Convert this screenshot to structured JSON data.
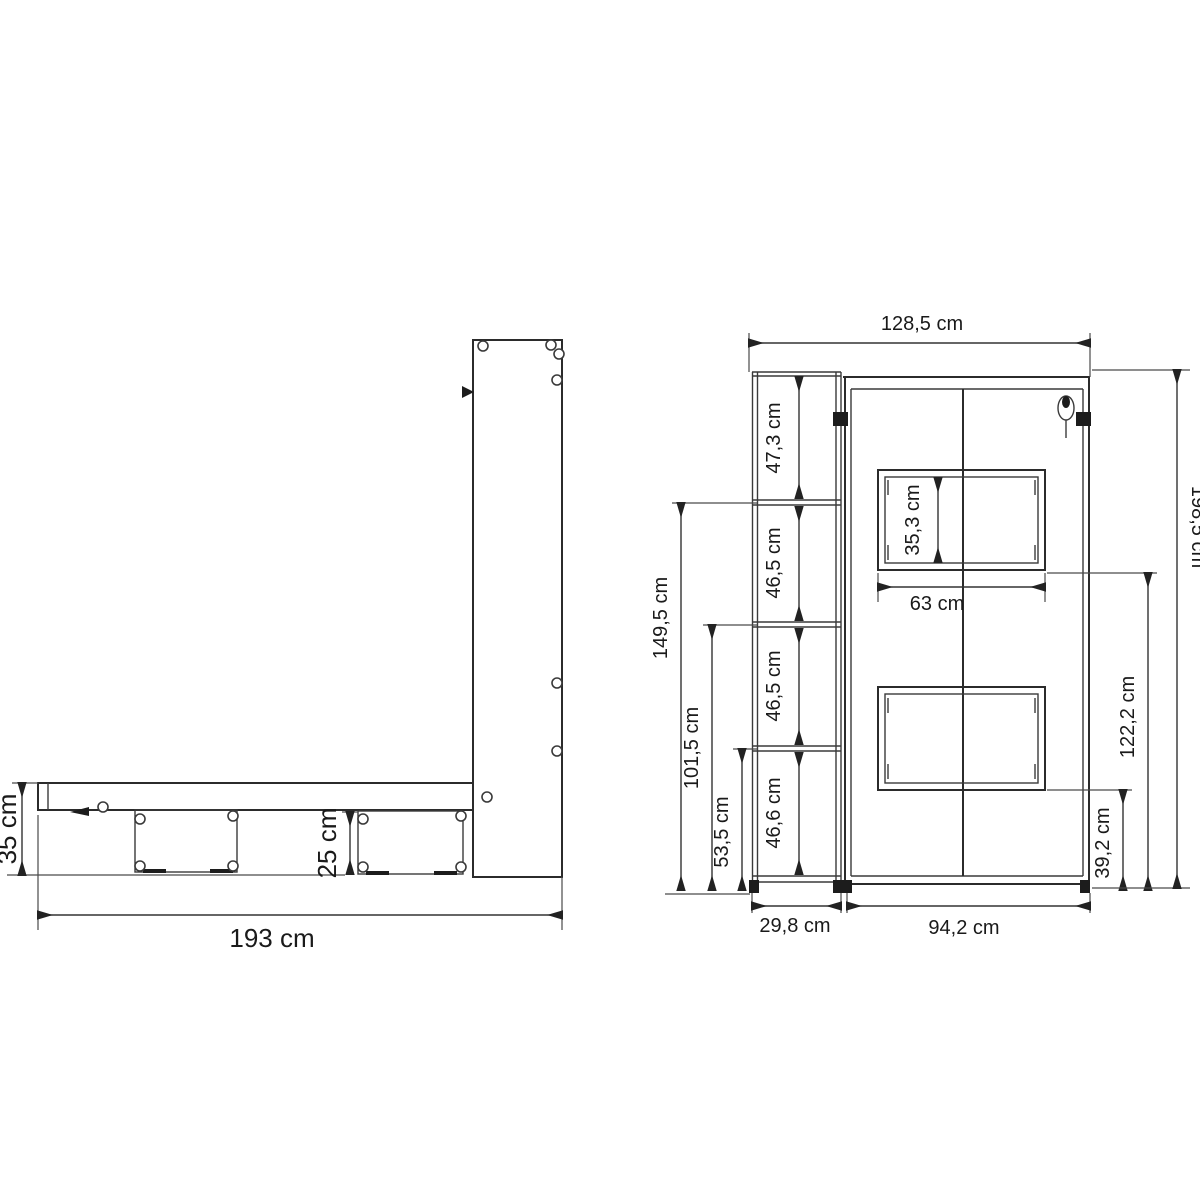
{
  "drawing": {
    "unit": "cm",
    "side_view": {
      "bed_frame_height": "35 cm",
      "leg_height": "25 cm",
      "total_length": "193 cm"
    },
    "front_view": {
      "total_width": "128,5 cm",
      "total_height": "198,5 cm",
      "shelf_section_top": "47,3 cm",
      "shelf_section_upper_mid": "46,5 cm",
      "shelf_section_lower_mid": "46,5 cm",
      "shelf_section_bottom": "46,6 cm",
      "shelf_level_top_height": "149,5 cm",
      "shelf_level_mid_height": "101,5 cm",
      "shelf_level_low_height": "53,5 cm",
      "upper_panel_height": "35,3 cm",
      "panel_width": "63 cm",
      "upper_panel_floor_distance": "122,2 cm",
      "lower_panel_floor_distance": "39,2 cm",
      "shelf_unit_width": "29,8 cm",
      "cabinet_width": "94,2 cm"
    }
  }
}
